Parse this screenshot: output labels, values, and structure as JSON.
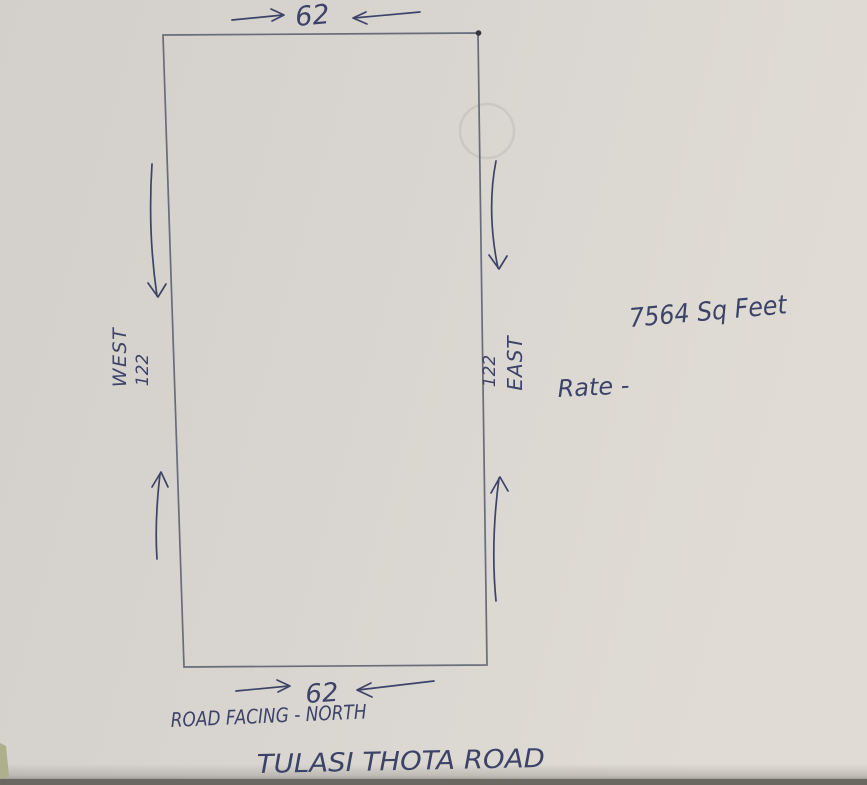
{
  "colors": {
    "paper": "#d7d3ce",
    "paper_light": "#dfdbd4",
    "ink": "#3d4368",
    "outline": "#686d7b",
    "photo_edge": "#6b6862",
    "table_sliver": "#adb08b"
  },
  "plot": {
    "top_width_label": "62",
    "bottom_width_label": "62",
    "left_direction_label": "WEST",
    "left_length_label": "122",
    "right_direction_label": "EAST",
    "right_length_label": "122",
    "area_label": "7564 Sq Feet",
    "rate_label": "Rate -",
    "road_facing_label": "ROAD FACING - NORTH",
    "road_name_label": "TULASI THOTA ROAD"
  }
}
